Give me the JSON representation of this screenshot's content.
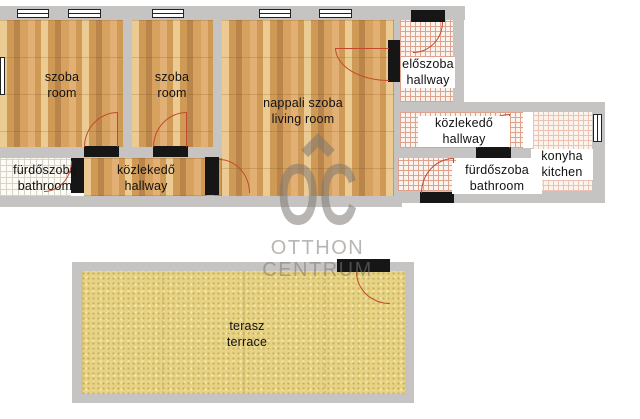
{
  "plan": {
    "rooms": {
      "room1": {
        "name_hu": "szoba",
        "name_en": "room"
      },
      "room2": {
        "name_hu": "szoba",
        "name_en": "room"
      },
      "living_room": {
        "name_hu": "nappali szoba",
        "name_en": "living room"
      },
      "bathroom_left": {
        "name_hu": "fürdőszoba",
        "name_en": "bathroom"
      },
      "hallway_left": {
        "name_hu": "közlekedő",
        "name_en": "hallway"
      },
      "entry_hall": {
        "name_hu": "előszoba",
        "name_en": "hallway"
      },
      "hallway_right": {
        "name_hu": "közlekedő",
        "name_en": "hallway"
      },
      "kitchen": {
        "name_hu": "konyha",
        "name_en": "kitchen"
      },
      "bathroom_right": {
        "name_hu": "fürdőszoba",
        "name_en": "bathroom"
      },
      "terrace": {
        "name_hu": "terasz",
        "name_en": "terrace"
      }
    }
  },
  "watermark": {
    "monogram": "OC",
    "line1": "OTTHON",
    "line2": "CENTRUM"
  },
  "colors": {
    "wall_gray": "#c6c4c2",
    "wood_base": "#d7a160",
    "wood_light": "#eccb93",
    "wood_mid": "#cf9a55",
    "wood_dark": "#b9854a",
    "wood_accent": "#e2b074",
    "tile_bg": "#fbf3ee",
    "tile_line_red": "#dfa28c",
    "tile_line_light": "#ecc2b2",
    "bath_bg": "#fcfbf6",
    "tile_line_gray": "#d8d3c6",
    "terrace_base": "#e7d385",
    "terrace_dot_dark": "#ccb25c",
    "terrace_dot_light": "#f5e9ae",
    "arc_red": "#c14a2e",
    "door_tan": "#d9b469",
    "frame_black": "#161616",
    "window_border": "#222222",
    "label_color": "#111111",
    "watermark_gray": "rgba(126,121,115,0.55)"
  }
}
